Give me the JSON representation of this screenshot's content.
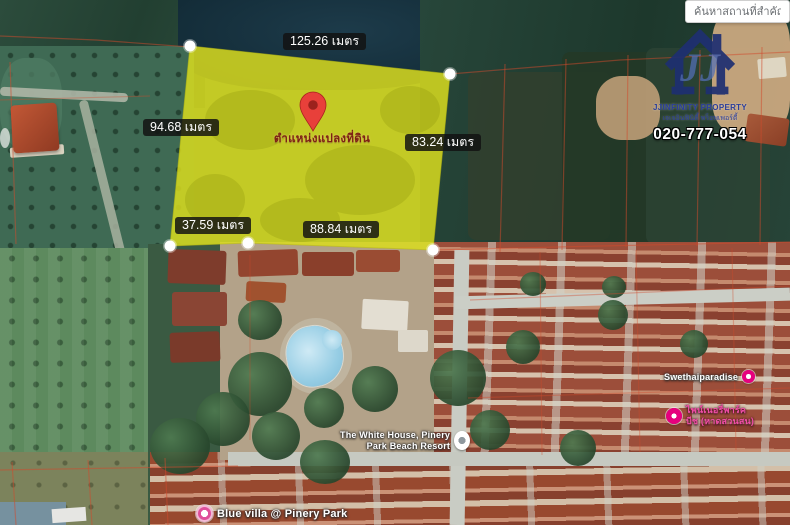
{
  "search": {
    "query_placeholder": "ค้นหาสถานที่สำคัญ"
  },
  "brand": {
    "name_en": "JJINFINITY PROPERTY",
    "name_th": "เจเจอินฟินิตี้ พร็อพเพอร์ตี้",
    "phone": "020-777-054"
  },
  "plot": {
    "caption": "ตำแหน่งแปลงที่ดิน",
    "fill_color": "#d9dc1f",
    "measurements": {
      "top": "125.26 เมตร",
      "left": "94.68 เมตร",
      "right": "83.24 เมตร",
      "bottom": "88.84 เมตร",
      "bottom_left": "37.59 เมตร"
    }
  },
  "poi": {
    "swethaiparadise": {
      "label": "Swethaiparadise"
    },
    "pinery_park_beach": {
      "line1": "ไพน์เนอรี่พาร์ค",
      "line2": "บีช (หาดสวนสน)"
    },
    "white_house": {
      "line1": "The White House, Pinery",
      "line2": "Park Beach Resort"
    },
    "blue_villa": {
      "label": "Blue villa @ Pinery Park"
    }
  },
  "colors": {
    "poi_pink": "#e6007e",
    "cadastral_red": "#d14a2c",
    "brand_navy": "#1e2f72"
  }
}
